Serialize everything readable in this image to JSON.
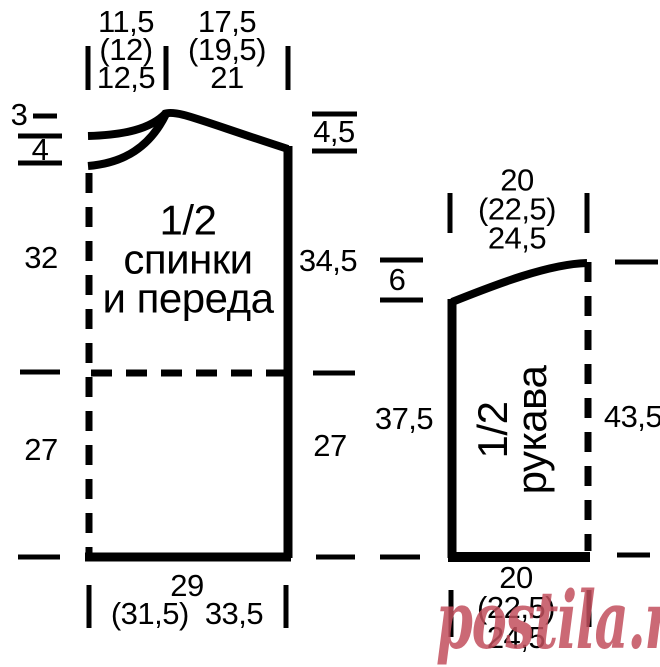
{
  "diagram_type": "knitting pattern schematic, 1/2 back-front piece and 1/2 sleeve, measurements in cm for three sizes",
  "colors": {
    "line": "#000000",
    "background": "#FFFFFF"
  },
  "body": {
    "title": [
      "1/2",
      "спинки",
      "и переда"
    ],
    "neck_width": [
      "11,5",
      "(12)",
      "12,5"
    ],
    "shoulder_width": [
      "17,5",
      "(19,5)",
      "21"
    ],
    "back_neck_depth": "3",
    "front_neck_depth": "4",
    "shoulder_slope": "4,5",
    "side_upper": "32",
    "armhole_side": "34,5",
    "side_lower_left": "27",
    "side_lower_right": "27",
    "hem_width_line1": "29",
    "hem_width_line2a": "(31,5)",
    "hem_width_line2b": "33,5"
  },
  "sleeve": {
    "title": [
      "1/2",
      "рукава"
    ],
    "top_width": [
      "20",
      "(22,5)",
      "24,5"
    ],
    "cap_height": "6",
    "side_left": "37,5",
    "side_right": "43,5",
    "bottom_width": [
      "20",
      "(22,5)",
      "24,5"
    ]
  },
  "watermark": {
    "text": "postila.ru",
    "color": "#C2505E",
    "opacity": "0.85"
  }
}
